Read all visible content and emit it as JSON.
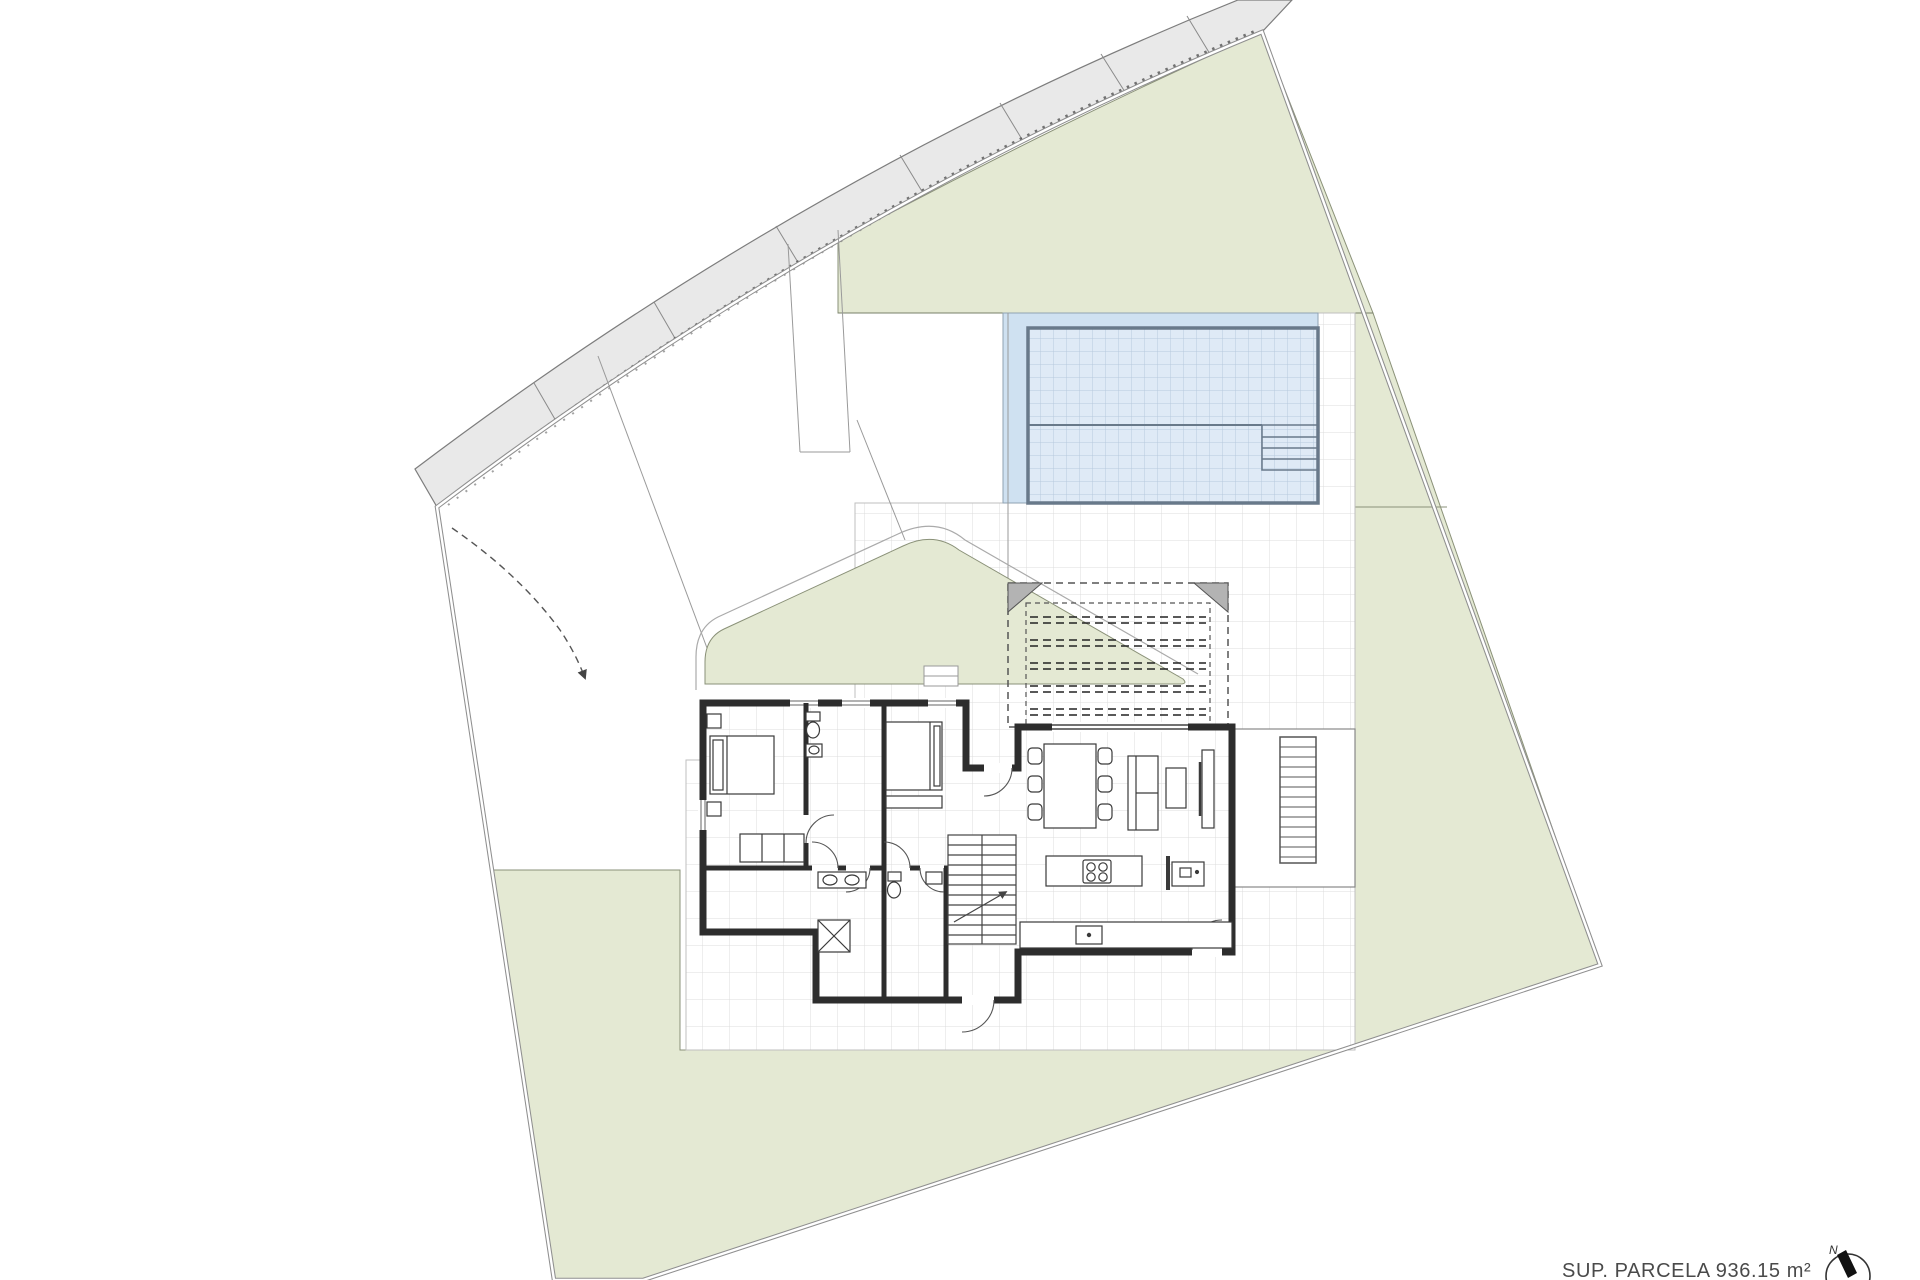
{
  "drawing": {
    "kind": "architectural-site-plan-ground-floor",
    "area_label": "SUP. PARCELA 936.15 m²",
    "north_letter": "N"
  },
  "palette": {
    "background": "#ffffff",
    "lawn": "#e4e9d3",
    "lawn_edge": "#8a9178",
    "road": "#e9e9e9",
    "road_edge": "#7d7d7d",
    "boundary": "#8f8f8f",
    "tile_line": "#dcdcdc",
    "pool_water": "#dfeaf6",
    "pool_grid": "#b7c9dd",
    "pool_deck": "#cfe1f1",
    "pool_border": "#68798a",
    "wall": "#2d2d2d",
    "furniture": "#3a3a3a",
    "pergola": "#555555",
    "label_text": "#4a4a4a"
  },
  "features": [
    "plot-boundary",
    "sidewalk-road-strip",
    "road-joints",
    "gravel-stipple-edge",
    "lawn-top-right",
    "lawn-main",
    "lawn-left-patch",
    "garden-island",
    "driveway",
    "driveway-joints",
    "turning-path-arc",
    "entrance-path",
    "terrace-tiles",
    "swimming-pool",
    "pool-deck",
    "pool-lane-divider",
    "pool-steps",
    "pergola-dashed",
    "pergola-slats",
    "pergola-supports",
    "wood-deck-platform",
    "wood-deck-steps",
    "house-footprint",
    "bedroom-1",
    "bedroom-2",
    "bathroom-1",
    "bathroom-2a",
    "bathroom-2b",
    "hallway",
    "staircase",
    "stair-direction-arrow",
    "bed-1",
    "bed-2",
    "wardrobe",
    "toilet",
    "sink",
    "shower",
    "dining-table",
    "dining-chairs",
    "sofa",
    "coffee-table",
    "tv-unit",
    "kitchen-island",
    "cooktop",
    "kitchen-counter",
    "kitchen-sink",
    "door-swings",
    "windows",
    "north-arrow",
    "area-label"
  ]
}
